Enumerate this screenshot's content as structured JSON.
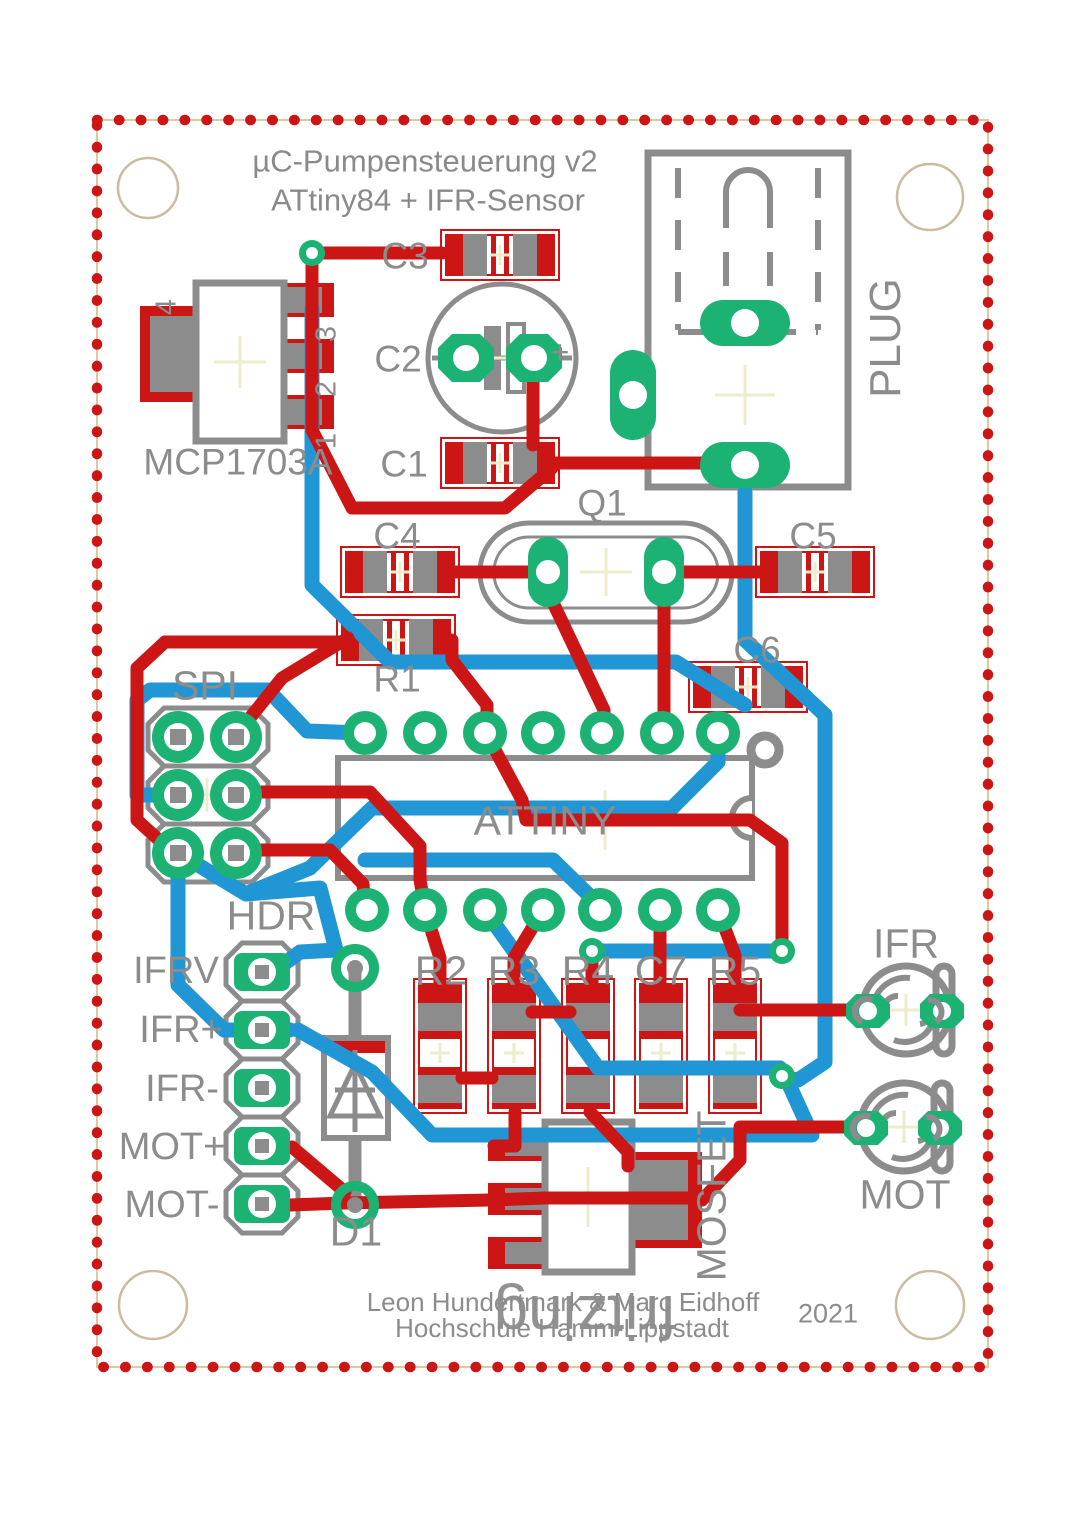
{
  "board": {
    "title_line1": "µC-Pumpensteuerung v2",
    "title_line2": "ATtiny84 + IFR-Sensor",
    "credit_line1": "Leon Hundertmark & Marc Eidhoff",
    "credit_line2": "Hochschule Hamm-Lippstadt",
    "year": "2021",
    "watermark": "fritzing"
  },
  "components": {
    "mcp": {
      "label": "MCP1703A",
      "pins": [
        "4",
        "3",
        "2",
        "1"
      ]
    },
    "c1": {
      "label": "C1"
    },
    "c2": {
      "label": "C2",
      "plus": "+"
    },
    "c3": {
      "label": "C3"
    },
    "c4": {
      "label": "C4"
    },
    "c5": {
      "label": "C5"
    },
    "c6": {
      "label": "C6"
    },
    "c7": {
      "label": "C7"
    },
    "r1": {
      "label": "R1"
    },
    "r2": {
      "label": "R2"
    },
    "r3": {
      "label": "R3"
    },
    "r4": {
      "label": "R4"
    },
    "r5": {
      "label": "R5"
    },
    "q1": {
      "label": "Q1"
    },
    "d1": {
      "label": "D1"
    },
    "plug": {
      "label": "PLUG"
    },
    "spi": {
      "label": "SPI"
    },
    "hdr": {
      "label": "HDR",
      "pins": [
        "IFRV",
        "IFR+",
        "IFR-",
        "MOT+",
        "MOT-"
      ]
    },
    "attiny": {
      "label": "ATTINY"
    },
    "mosfet": {
      "label": "MOSFET"
    },
    "ifr": {
      "label": "IFR"
    },
    "mot": {
      "label": "MOT"
    }
  },
  "colors": {
    "copper_top": "#cc1616",
    "copper_bottom": "#2196d4",
    "pad_green": "#1bb273",
    "silkscreen": "#8c8c8c",
    "board_outline_dots": "#cc1616",
    "board_outline_line": "#dcc9a0",
    "hole_ring": "#c9bd9f",
    "cross_mark": "#eeeccb"
  }
}
